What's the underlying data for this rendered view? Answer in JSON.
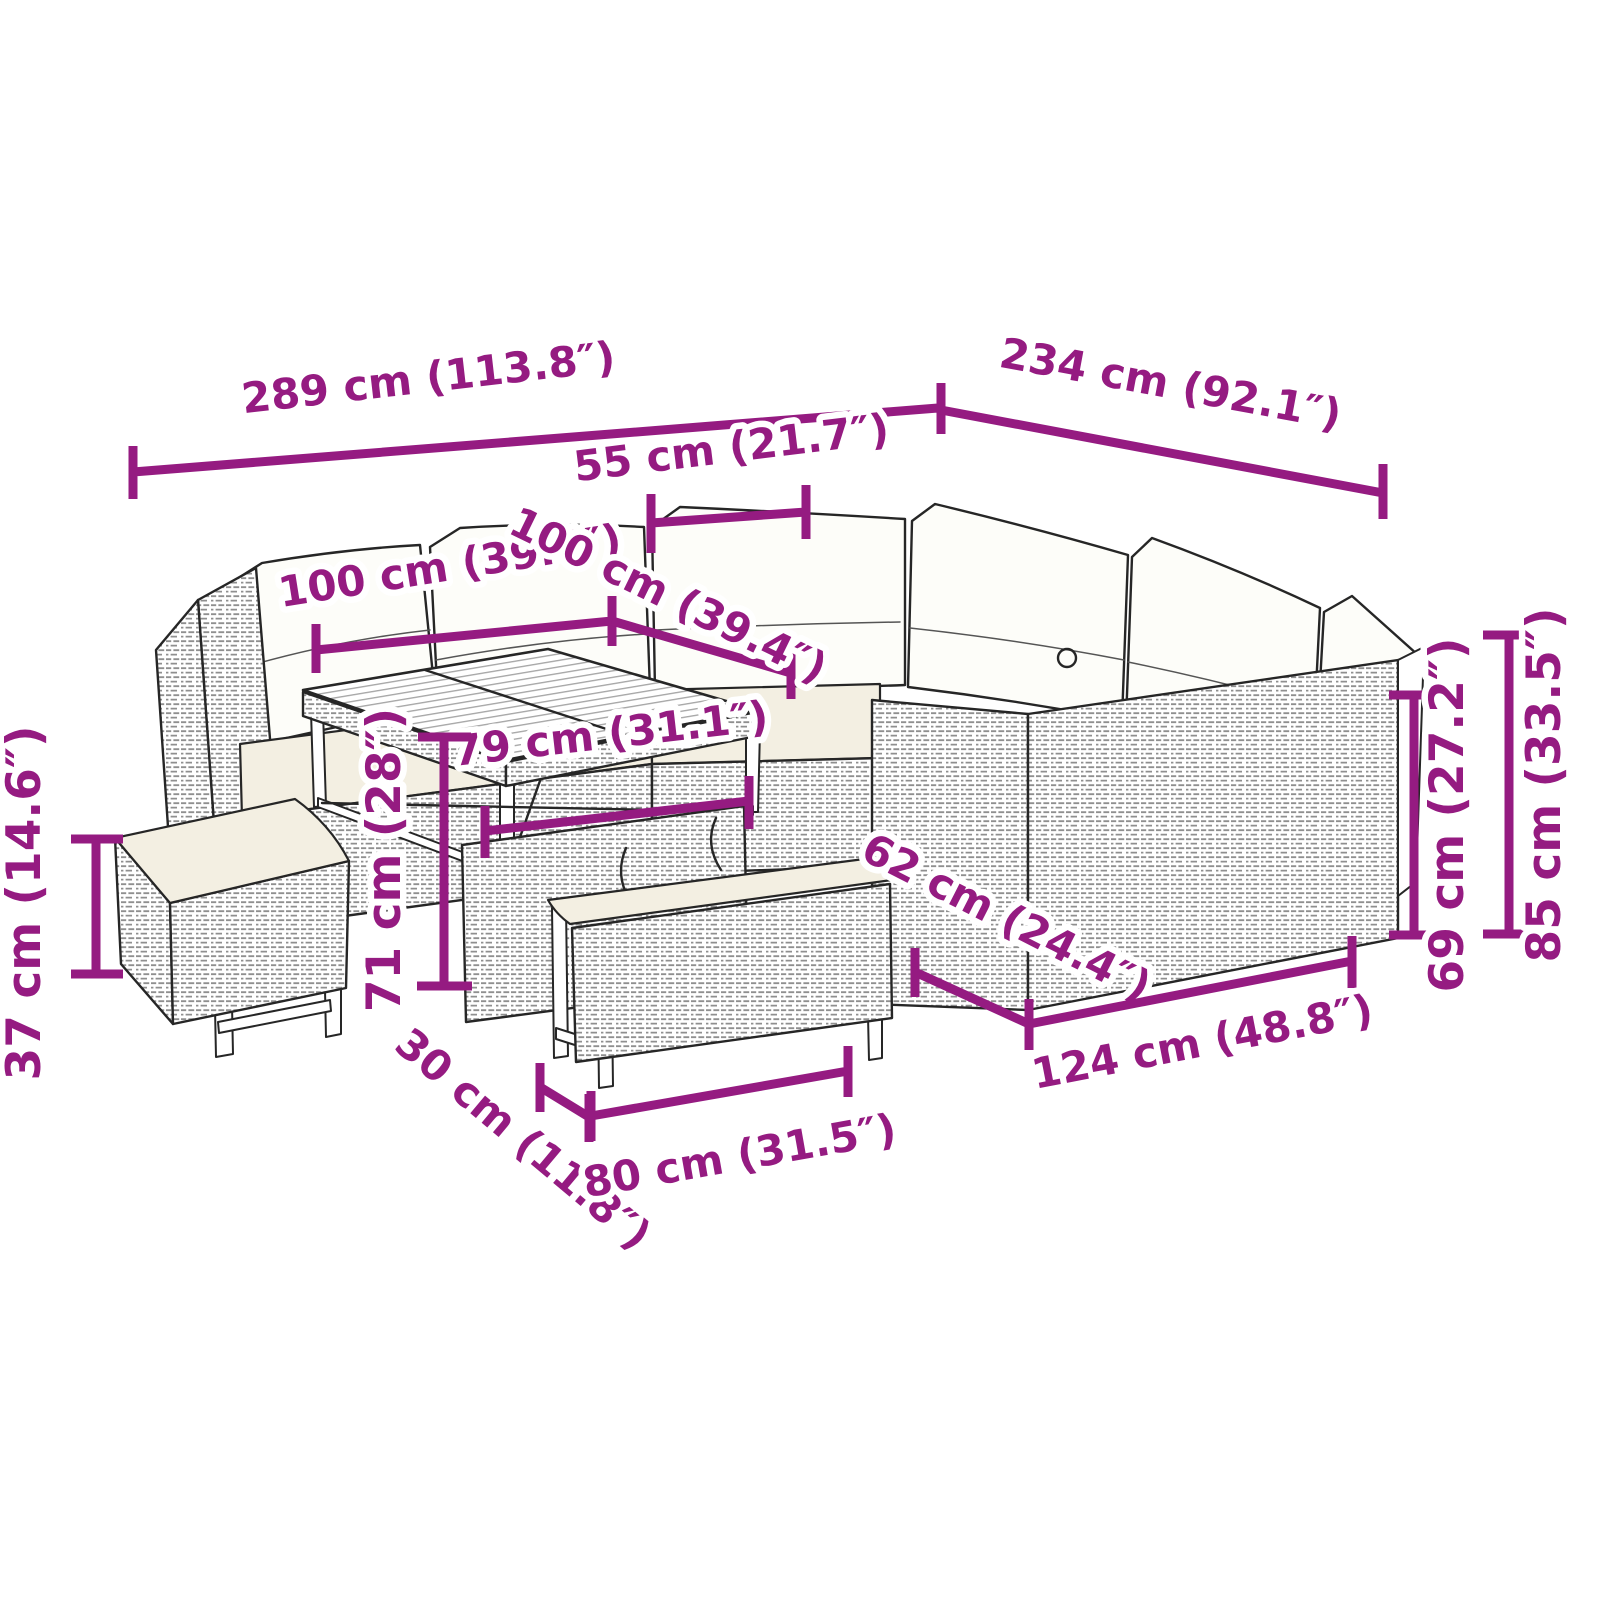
{
  "diagram": {
    "type": "product-dimension-diagram",
    "subject": "rattan garden lounge set with corner sofa, cube table and two benches",
    "accent_color": "#951b81",
    "artwork_line_color": "#262626",
    "cushion_color": "#fdfdf9",
    "seat_cushion_color": "#f3efe2",
    "dimensions": {
      "overall_width": "289 cm (113.8″)",
      "overall_depth": "234 cm (92.1″)",
      "corner_section_width": "55 cm (21.7″)",
      "left_section_length": "100 cm (39.4″)",
      "right_section_length": "100 cm (39.4″)",
      "table_length": "79 cm (31.1″)",
      "table_height": "71 cm (28″)",
      "bench_height": "37 cm (14.6″)",
      "bench_depth": "30 cm (11.8″)",
      "bench_length": "80 cm (31.5″)",
      "seat_depth": "62 cm (24.4″)",
      "sofa_section_length": "124 cm (48.8″)",
      "seat_back_height": "69 cm (27.2″)",
      "total_height": "85 cm (33.5″)"
    }
  }
}
